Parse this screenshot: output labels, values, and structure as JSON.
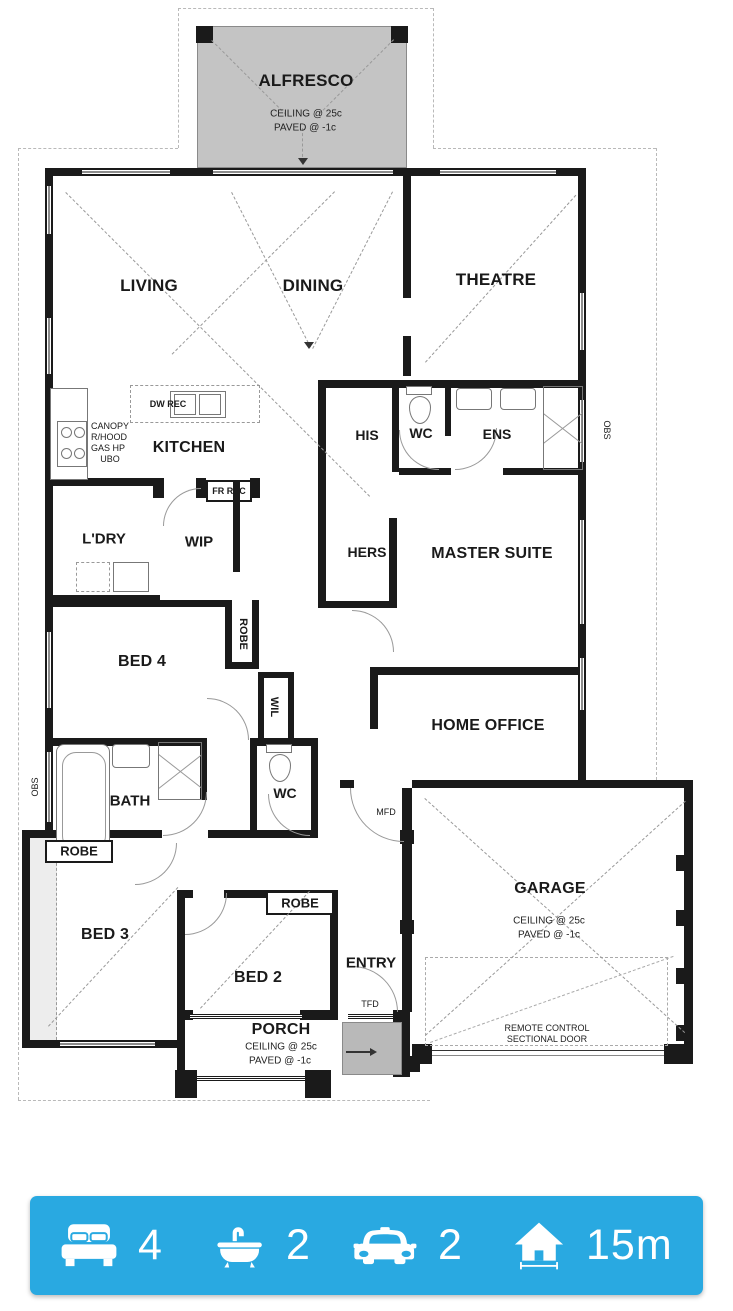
{
  "plan": {
    "alfresco": {
      "name": "ALFRESCO",
      "line1": "CEILING @ 25c",
      "line2": "PAVED @ -1c"
    },
    "living": "LIVING",
    "dining": "DINING",
    "theatre": "THEATRE",
    "kitchen": "KITCHEN",
    "canopy": [
      "CANOPY",
      "R/HOOD",
      "GAS HP",
      "UBO"
    ],
    "dw_rec": "DW REC",
    "fr_rec": "FR REC",
    "his": "HIS",
    "wc_top": "WC",
    "ens": "ENS",
    "ldry": "L'DRY",
    "wip": "WIP",
    "hers": "HERS",
    "master": "MASTER SUITE",
    "bed4": "BED 4",
    "robe_bed4": "ROBE",
    "wil": "WIL",
    "home_office": "HOME OFFICE",
    "mfd": "MFD",
    "bath": "BATH",
    "wc_bottom": "WC",
    "obs_left": "OBS",
    "obs_right": "OBS",
    "robe_left": "ROBE",
    "bed3": "BED 3",
    "bed2": "BED 2",
    "robe_bed2": "ROBE",
    "entry": "ENTRY",
    "tfd": "TFD",
    "porch": {
      "name": "PORCH",
      "line1": "CEILING @ 25c",
      "line2": "PAVED @ -1c"
    },
    "garage": {
      "name": "GARAGE",
      "line1": "CEILING @ 25c",
      "line2": "PAVED @ -1c",
      "door1": "REMOTE CONTROL",
      "door2": "SECTIONAL DOOR"
    }
  },
  "summary": {
    "accent_blue": "#29A9E1",
    "items": [
      {
        "icon": "bed-icon",
        "value": "4"
      },
      {
        "icon": "bath-icon",
        "value": "2"
      },
      {
        "icon": "car-icon",
        "value": "2"
      },
      {
        "icon": "house-width-icon",
        "value": "15m"
      }
    ]
  },
  "colors": {
    "wall_black": "#1A1A1A",
    "paved_grey": "#C4C4C4"
  }
}
